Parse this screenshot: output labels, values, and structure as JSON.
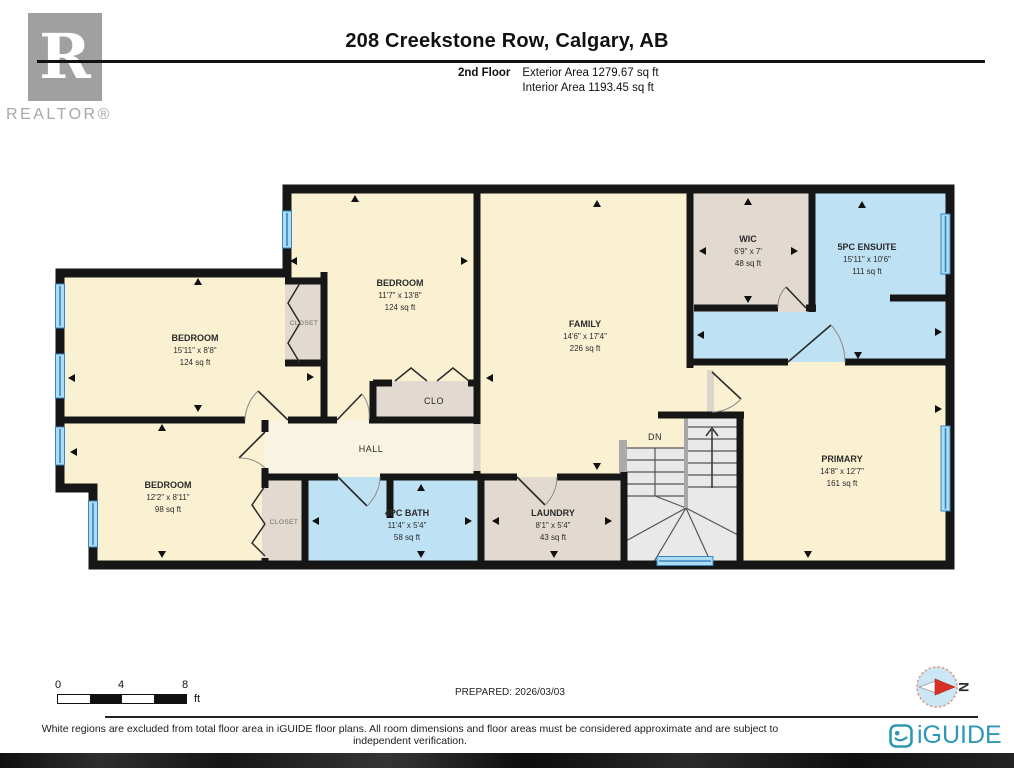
{
  "header": {
    "title": "208 Creekstone Row, Calgary, AB",
    "floor_label": "2nd Floor",
    "exterior_area": "Exterior Area 1279.67 sq ft",
    "interior_area": "Interior Area 1193.45 sq ft"
  },
  "branding": {
    "realtor_letter": "R",
    "realtor_name": "REALTOR®",
    "iguide_name": "iGUIDE"
  },
  "rooms": [
    {
      "id": "bedroom-upper-left",
      "name": "BEDROOM",
      "dims": "15'11\" x 8'8\"",
      "area": "124 sq ft"
    },
    {
      "id": "bedroom-middle",
      "name": "BEDROOM",
      "dims": "11'7\" x 13'8\"",
      "area": "124 sq ft"
    },
    {
      "id": "family",
      "name": "FAMILY",
      "dims": "14'6\" x 17'4\"",
      "area": "226 sq ft"
    },
    {
      "id": "wic",
      "name": "WIC",
      "dims": "6'9\" x 7'",
      "area": "48 sq ft"
    },
    {
      "id": "ensuite",
      "name": "5PC ENSUITE",
      "dims": "15'11\" x 10'6\"",
      "area": "111 sq ft"
    },
    {
      "id": "primary",
      "name": "PRIMARY",
      "dims": "14'8\" x 12'7\"",
      "area": "161 sq ft"
    },
    {
      "id": "bedroom-lower-left",
      "name": "BEDROOM",
      "dims": "12'2\" x 8'11\"",
      "area": "98 sq ft"
    },
    {
      "id": "bath",
      "name": "4PC BATH",
      "dims": "11'4\" x 5'4\"",
      "area": "58 sq ft"
    },
    {
      "id": "laundry",
      "name": "LAUNDRY",
      "dims": "8'1\" x 5'4\"",
      "area": "43 sq ft"
    }
  ],
  "labels": {
    "hall": "HALL",
    "closet_upper": "CLOSET",
    "closet_lower": "CLOSET",
    "clo": "CLO",
    "stairs_dn": "DN"
  },
  "scale_bar": {
    "ticks": [
      "0",
      "4",
      "8"
    ],
    "unit": "ft"
  },
  "prepared_label": "PREPARED: 2026/03/03",
  "compass": {
    "letter": "N"
  },
  "footer": {
    "disclaimer": "White regions are excluded from total floor area in iGUIDE floor plans. All room dimensions and floor areas must be considered approximate and are subject to independent verification."
  },
  "colors": {
    "room_cream": "#FAF1D2",
    "hall_cream": "#F9F3E2",
    "closet_beige": "#E2DAD0",
    "wet_blue": "#BFE1F4",
    "window_blue": "#AEDCF4",
    "window_line": "#3A86C0",
    "wall": "#161616",
    "stairs_gray": "#E9E9E9",
    "brand_teal": "#2F97B6",
    "compass_red": "#D93025"
  }
}
